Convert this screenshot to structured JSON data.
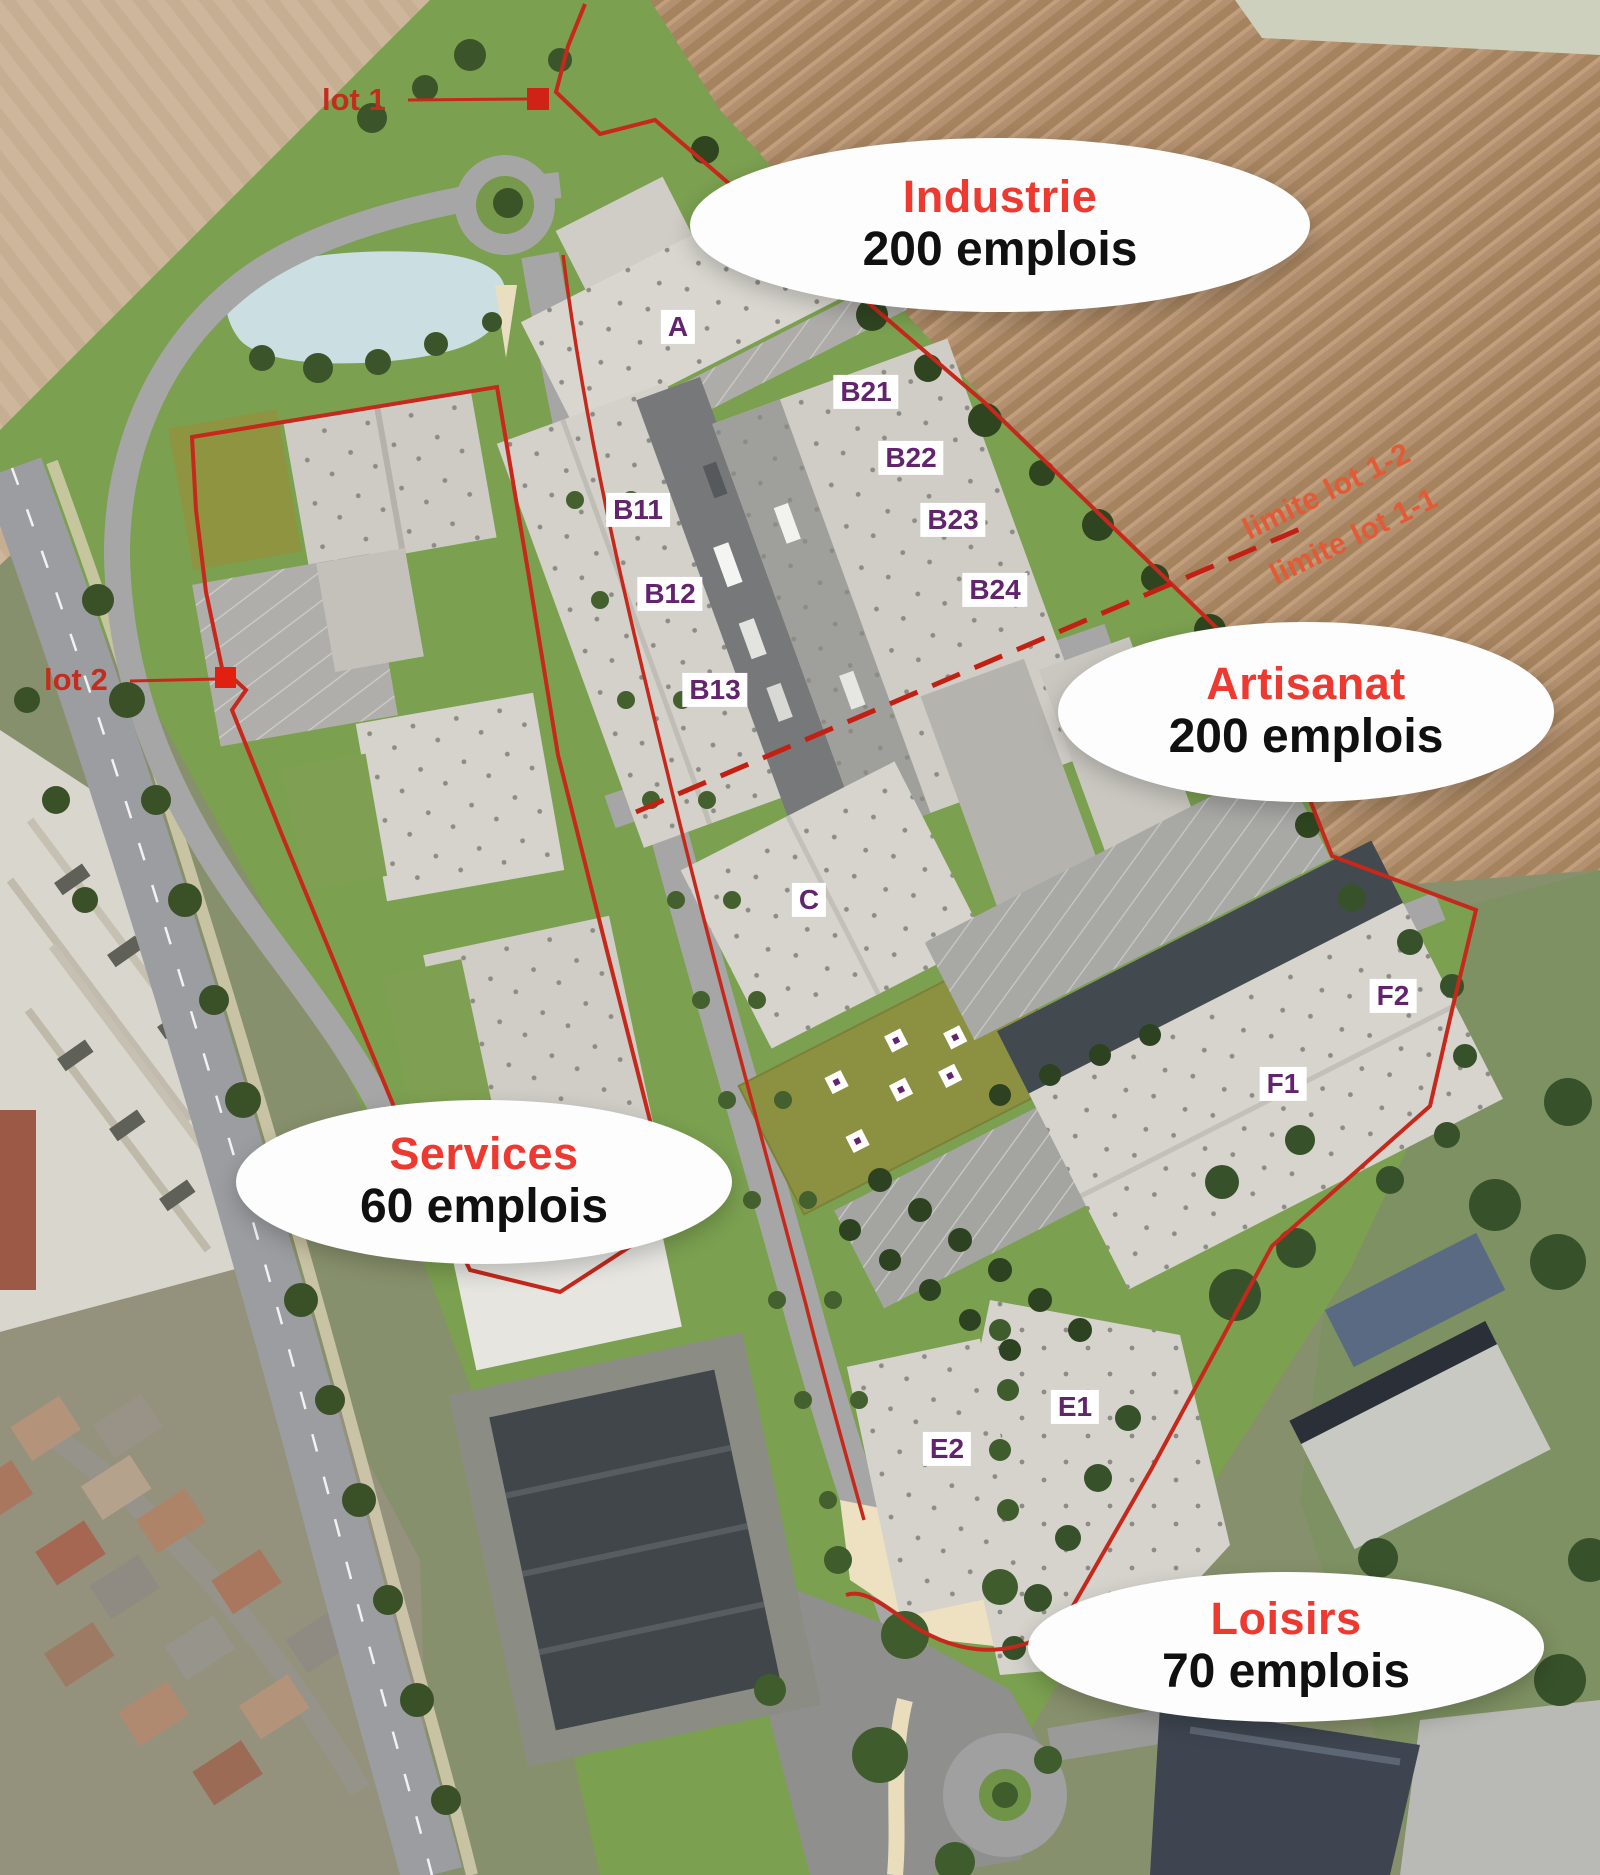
{
  "map": {
    "callouts": [
      {
        "title": "Industrie",
        "jobs": "200 emplois"
      },
      {
        "title": "Artisanat",
        "jobs": "200 emplois"
      },
      {
        "title": "Services",
        "jobs": "60 emplois"
      },
      {
        "title": "Loisirs",
        "jobs": "70 emplois"
      }
    ],
    "lot_markers": [
      {
        "label": "lot 1"
      },
      {
        "label": "lot 2"
      }
    ],
    "limit_labels": [
      {
        "label": "limite lot 1-2"
      },
      {
        "label": "limite lot 1-1"
      }
    ],
    "building_labels": [
      {
        "label": "A"
      },
      {
        "label": "B11"
      },
      {
        "label": "B12"
      },
      {
        "label": "B13"
      },
      {
        "label": "B21"
      },
      {
        "label": "B22"
      },
      {
        "label": "B23"
      },
      {
        "label": "B24"
      },
      {
        "label": "C"
      },
      {
        "label": "E1"
      },
      {
        "label": "E2"
      },
      {
        "label": "F1"
      },
      {
        "label": "F2"
      }
    ],
    "colors": {
      "zone_title": "#ee3931",
      "jobs_text": "#101010",
      "building_label": "#63246e",
      "boundary_red": "#c6281c",
      "limit_text": "#e25a36"
    }
  }
}
